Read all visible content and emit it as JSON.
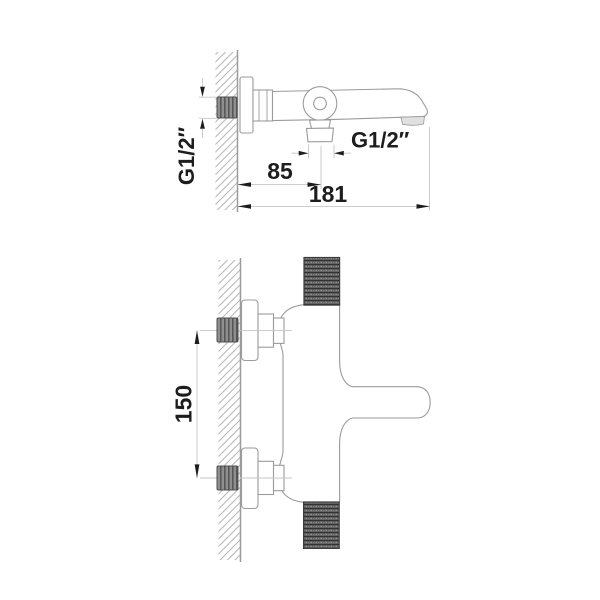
{
  "drawing_title": "wall-mounted bath mixer technical drawing",
  "colors": {
    "background": "#ffffff",
    "line": "#9b9b9b",
    "hatch": "#b6b6b6",
    "dim_line": "#c6c6c6",
    "ink": "#1d1d1d",
    "nut_fill": "#8f8f8f",
    "nut_stripe": "#575757",
    "knurl_base": "#5f5f5f",
    "knurl_dark": "#333333",
    "aerator_fill": "#e0e0e0"
  },
  "side_view": {
    "inlet_thread_label": "G1/2″",
    "outlet_thread_label": "G1/2″",
    "dim_wall_to_outlet": "85",
    "dim_wall_to_spout_tip": "181"
  },
  "plan_view": {
    "dim_connection_spacing": "150"
  }
}
